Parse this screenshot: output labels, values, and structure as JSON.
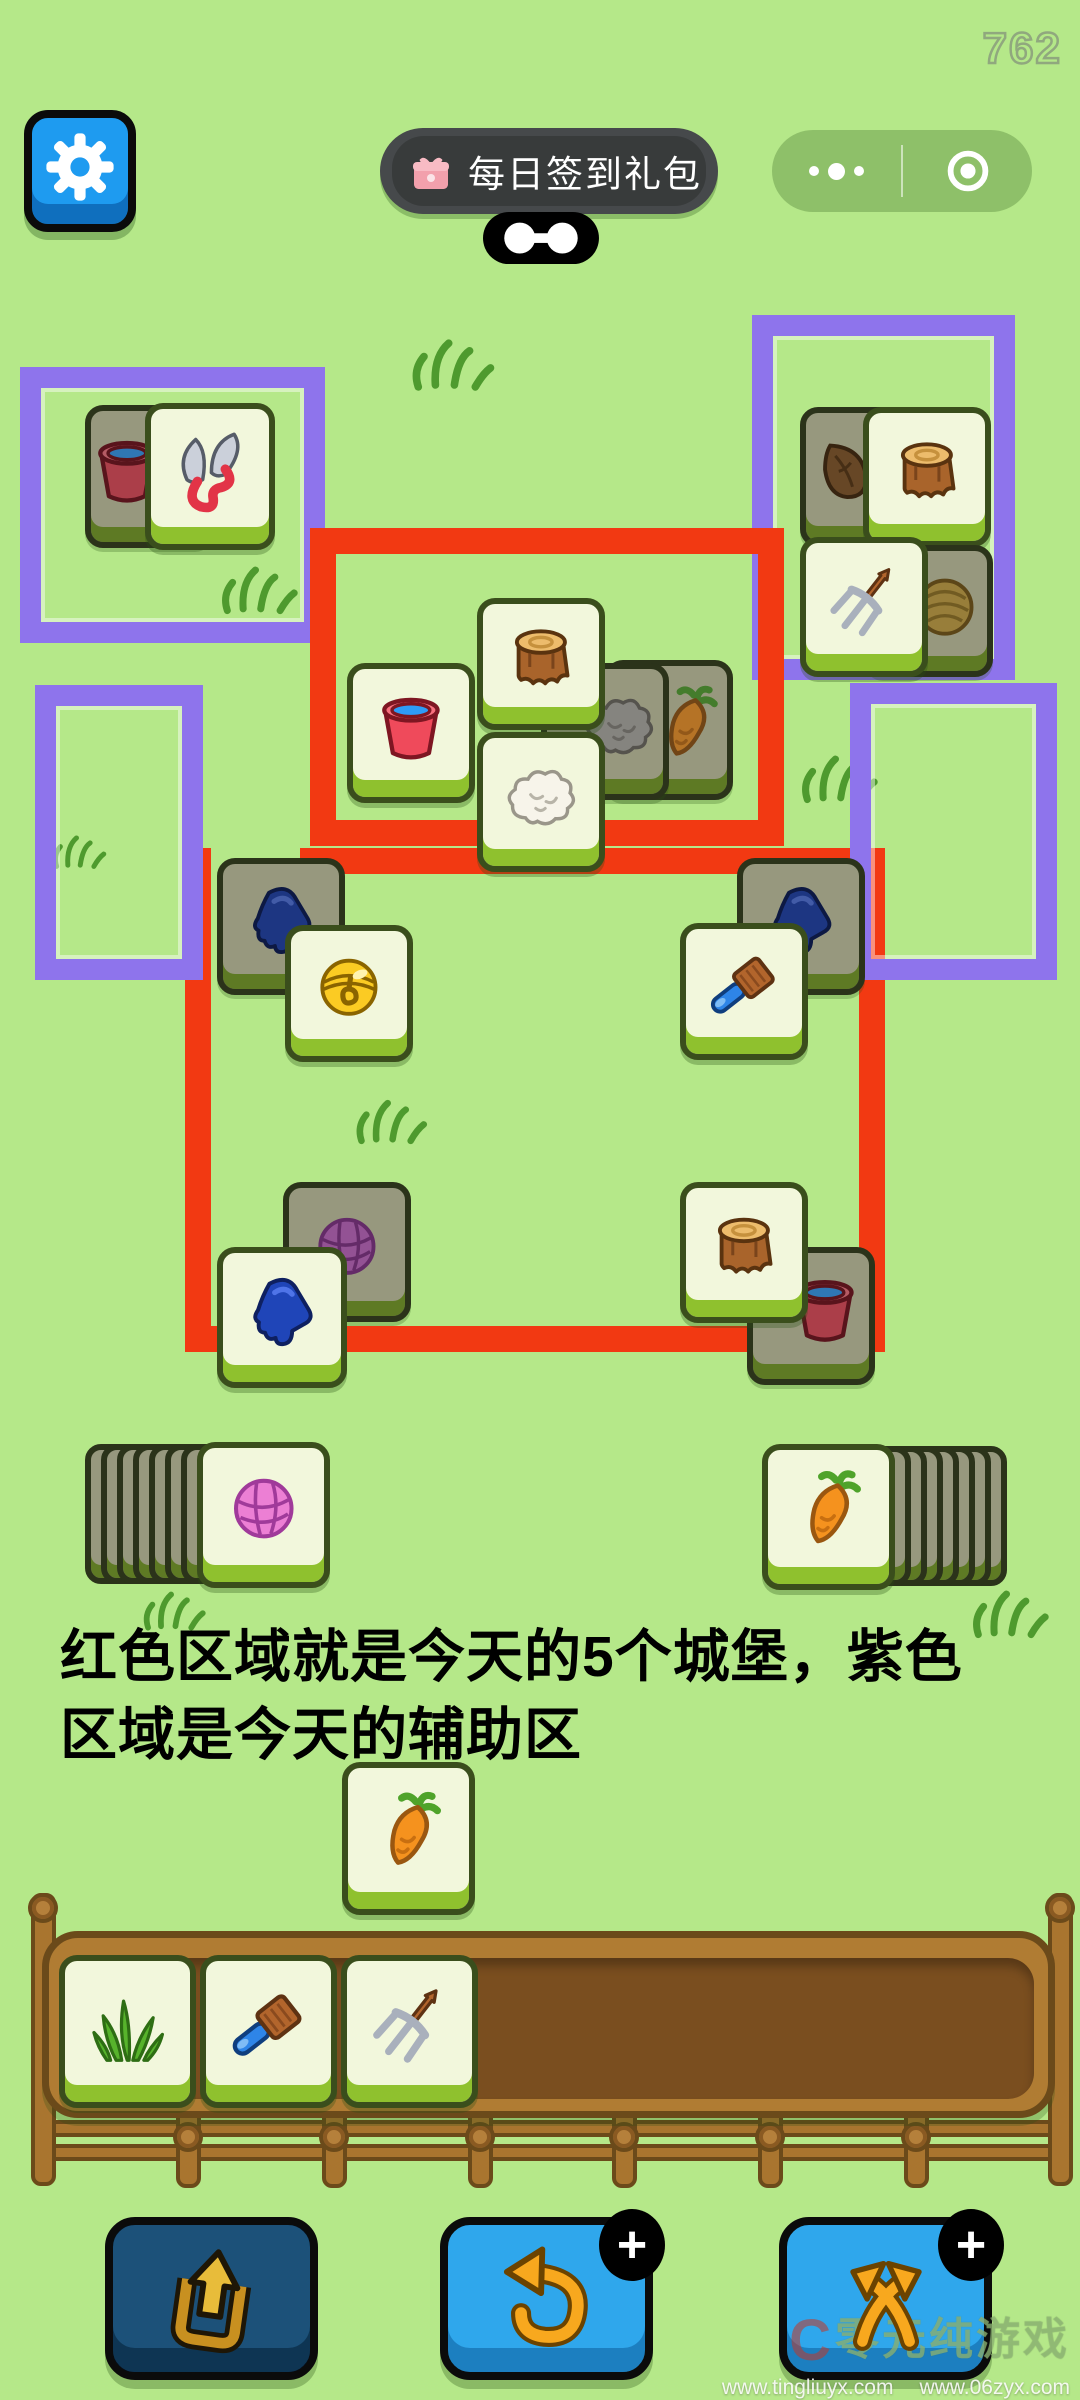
{
  "hud": {
    "score": "762",
    "signin_label": "每日签到礼包"
  },
  "annotation": {
    "line1": "红色区域就是今天的5个城堡，紫色",
    "line2": "区域是今天的辅助区"
  },
  "watermark": {
    "logo": "C",
    "title": "零元纯游戏",
    "url_left": "www.tingliuyx.com",
    "url_right": "www.06zyx.com"
  },
  "colors": {
    "background": "#B5E889",
    "red_zone": "#F23912",
    "purple_zone": "#8E74EC",
    "tile_light_face": "#F2F7DC",
    "tile_dark_face": "#97987E",
    "accent_blue": "#2FA7EC"
  },
  "board": {
    "red_rects": [
      {
        "x": 310,
        "y": 528,
        "w": 474,
        "h": 318
      }
    ],
    "red_bars": [
      {
        "x": 300,
        "y": 848,
        "w": 585,
        "h": 26
      },
      {
        "x": 185,
        "y": 848,
        "w": 26,
        "h": 504
      },
      {
        "x": 185,
        "y": 1326,
        "w": 700,
        "h": 26
      },
      {
        "x": 859,
        "y": 848,
        "w": 26,
        "h": 504
      }
    ],
    "purple_rects": [
      {
        "x": 20,
        "y": 367,
        "w": 305,
        "h": 276
      },
      {
        "x": 752,
        "y": 315,
        "w": 263,
        "h": 365
      },
      {
        "x": 35,
        "y": 685,
        "w": 168,
        "h": 295
      },
      {
        "x": 850,
        "y": 683,
        "w": 207,
        "h": 297
      }
    ],
    "grass": [
      {
        "x": 405,
        "y": 328,
        "s": 95
      },
      {
        "x": 215,
        "y": 556,
        "s": 88
      },
      {
        "x": 48,
        "y": 828,
        "s": 62
      },
      {
        "x": 795,
        "y": 745,
        "s": 88
      },
      {
        "x": 350,
        "y": 1090,
        "s": 82
      },
      {
        "x": 138,
        "y": 1583,
        "s": 72
      },
      {
        "x": 966,
        "y": 1580,
        "s": 88
      }
    ],
    "tiles": [
      {
        "icon": "bucket",
        "variant": "dark",
        "x": 85,
        "y": 405,
        "w": 128,
        "h": 143,
        "ix": -22
      },
      {
        "icon": "shears",
        "variant": "light",
        "x": 145,
        "y": 403,
        "w": 130,
        "h": 147,
        "ix": 0
      },
      {
        "icon": "leaf",
        "variant": "dark",
        "x": 800,
        "y": 407,
        "w": 128,
        "h": 140,
        "ix": -20
      },
      {
        "icon": "stump",
        "variant": "light",
        "x": 863,
        "y": 407,
        "w": 128,
        "h": 140,
        "ix": 0
      },
      {
        "icon": "hay",
        "variant": "dark",
        "x": 865,
        "y": 545,
        "w": 128,
        "h": 132,
        "ix": 16
      },
      {
        "icon": "pitchfork",
        "variant": "light",
        "x": 800,
        "y": 537,
        "w": 128,
        "h": 140,
        "ix": 0
      },
      {
        "icon": "carrot",
        "variant": "dark",
        "x": 605,
        "y": 660,
        "w": 128,
        "h": 140,
        "ix": 18
      },
      {
        "icon": "wool_gray",
        "variant": "dark",
        "x": 541,
        "y": 663,
        "w": 128,
        "h": 137,
        "ix": 14
      },
      {
        "icon": "stump",
        "variant": "light",
        "x": 477,
        "y": 598,
        "w": 128,
        "h": 132,
        "ix": 0
      },
      {
        "icon": "wool_white",
        "variant": "light",
        "x": 477,
        "y": 732,
        "w": 128,
        "h": 140,
        "ix": 0
      },
      {
        "icon": "bucket",
        "variant": "light",
        "x": 347,
        "y": 663,
        "w": 128,
        "h": 140,
        "ix": 0
      },
      {
        "icon": "glove",
        "variant": "dark",
        "x": 217,
        "y": 858,
        "w": 128,
        "h": 137,
        "ix": 0
      },
      {
        "icon": "bell",
        "variant": "light",
        "x": 285,
        "y": 925,
        "w": 128,
        "h": 137,
        "ix": 0
      },
      {
        "icon": "glove",
        "variant": "dark",
        "x": 737,
        "y": 858,
        "w": 128,
        "h": 137,
        "ix": 0
      },
      {
        "icon": "brush",
        "variant": "light",
        "x": 680,
        "y": 923,
        "w": 128,
        "h": 137,
        "ix": 0
      },
      {
        "icon": "yarn",
        "variant": "dark",
        "x": 283,
        "y": 1182,
        "w": 128,
        "h": 140,
        "ix": 0
      },
      {
        "icon": "glove",
        "variant": "light",
        "x": 217,
        "y": 1247,
        "w": 130,
        "h": 141,
        "ix": 0
      },
      {
        "icon": "bucket",
        "variant": "dark",
        "x": 747,
        "y": 1247,
        "w": 128,
        "h": 138,
        "ix": 14
      },
      {
        "icon": "stump",
        "variant": "light",
        "x": 680,
        "y": 1182,
        "w": 128,
        "h": 141,
        "ix": 0
      },
      {
        "icon": "carrot",
        "variant": "light",
        "x": 342,
        "y": 1762,
        "w": 133,
        "h": 153,
        "ix": 0
      }
    ]
  },
  "piles": {
    "left": {
      "backs": 7,
      "face_icon": "yarn_pink",
      "x": 85,
      "y": 1442
    },
    "right": {
      "backs": 8,
      "face_icon": "carrot",
      "x": 762,
      "y": 1444
    }
  },
  "tray": {
    "tiles": [
      "grass",
      "brush",
      "pitchfork"
    ]
  },
  "buttons": [
    {
      "id": "eject",
      "icon": "pocket",
      "disabled": true,
      "badge": ""
    },
    {
      "id": "undo",
      "icon": "undo",
      "disabled": false,
      "badge": "+"
    },
    {
      "id": "shuffle",
      "icon": "shuffle",
      "disabled": false,
      "badge": "+"
    }
  ]
}
